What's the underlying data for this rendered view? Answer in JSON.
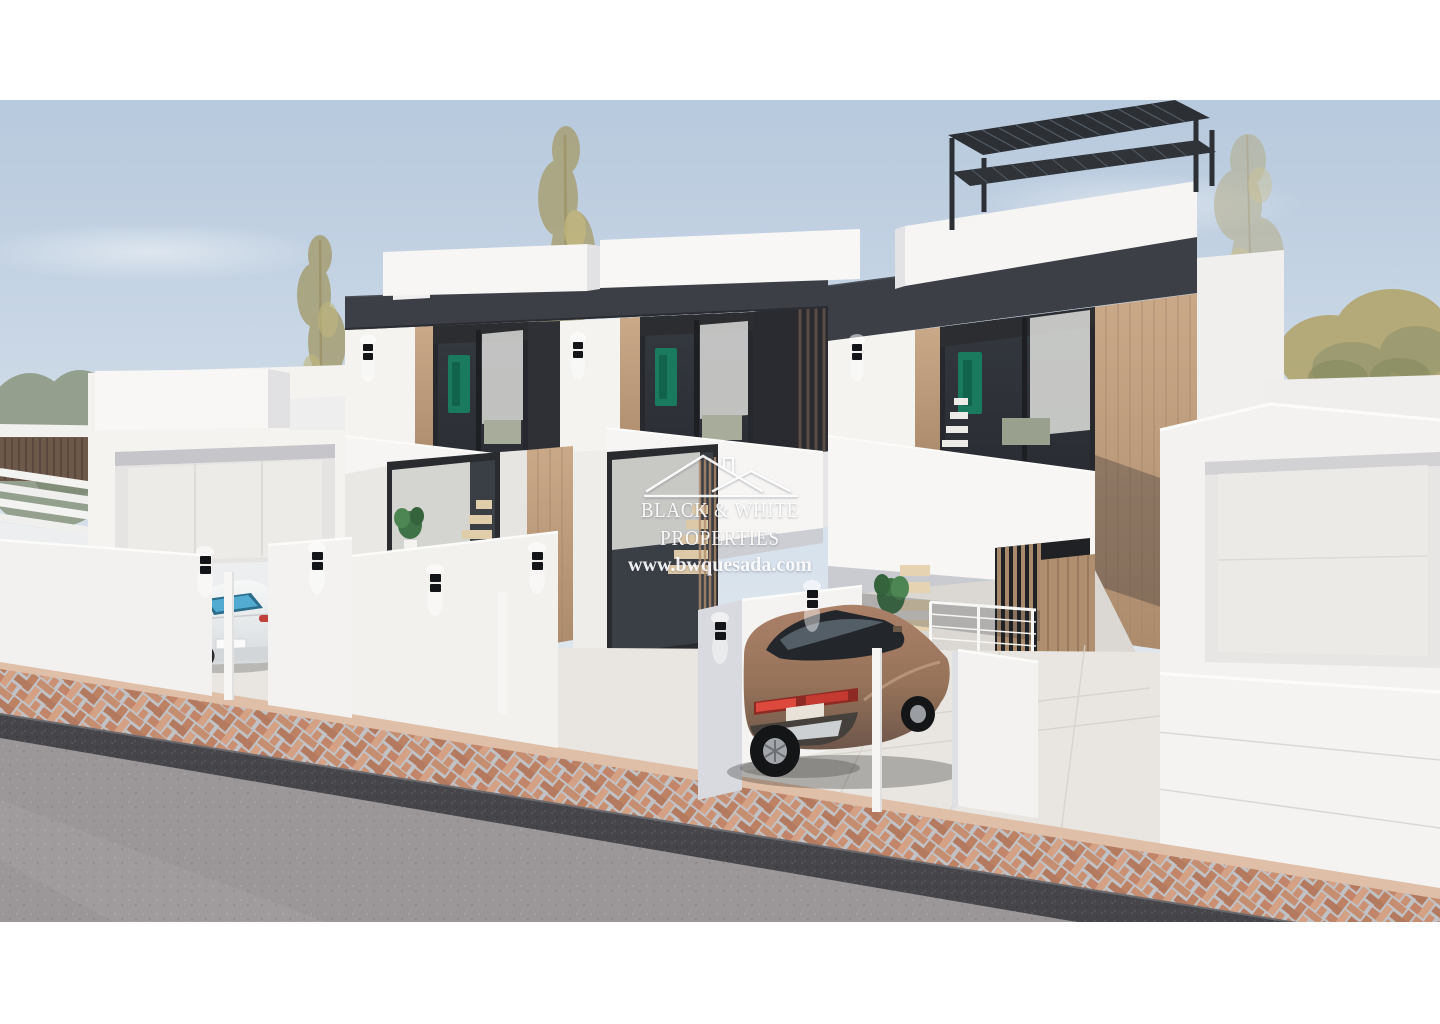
{
  "watermark": {
    "logo_icon": "house-roofs-logo",
    "line1": "BLACK & WHITE",
    "line2": "PROPERTIES",
    "website": "www.bwquesada.com",
    "color": "#ffffff"
  },
  "palette": {
    "sky_top": "#b7c9dd",
    "sky_mid": "#d5e0eb",
    "sky_horizon": "#e7ecf1",
    "white_sunlit": "#f4f3f0",
    "white_shade": "#dfe0e4",
    "fascia_dark": "#3c3f45",
    "wood_light": "#c9a988",
    "wood_dark": "#ac8b6d",
    "glass_dark": "#2c3036",
    "road_asphalt": "#9b9698",
    "sidewalk_brick": "#c68e70",
    "curb_dark": "#46464a",
    "suv_bronze": "#96735a",
    "sedan_white": "#eef0f1",
    "foliage_olive": "#a79e6f",
    "watermark_color": "#ffffff"
  }
}
